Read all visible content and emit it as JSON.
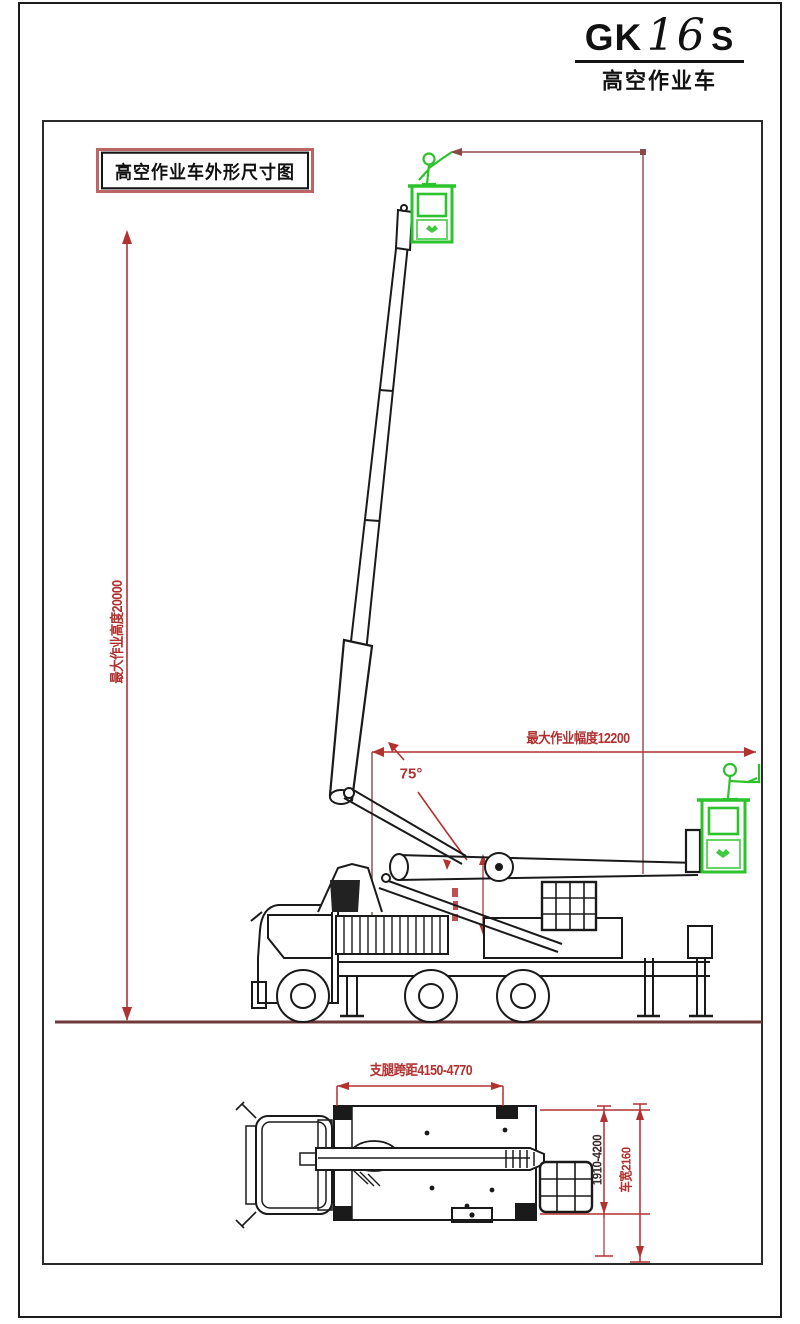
{
  "title_block": {
    "model_prefix": "GK",
    "model_digits": "16",
    "model_suffix": "S",
    "subtitle": "高空作业车"
  },
  "drawing": {
    "label": "高空作业车外形尺寸图",
    "dimensions": {
      "max_working_height": "最大作业高度20000",
      "max_working_reach": "最大作业幅度12200",
      "boom_angle": "75°",
      "outrigger_span": "支腿跨距4150-4770",
      "outrigger_extension_width": "1910-4200",
      "vehicle_width": "车宽2160"
    },
    "colors": {
      "dimension_red": "#b23131",
      "dark_red": "#8a4a4a",
      "ground_red": "#6e3a3a",
      "line_black": "#1a1a1a",
      "basket_green": "#2cc32c"
    }
  }
}
